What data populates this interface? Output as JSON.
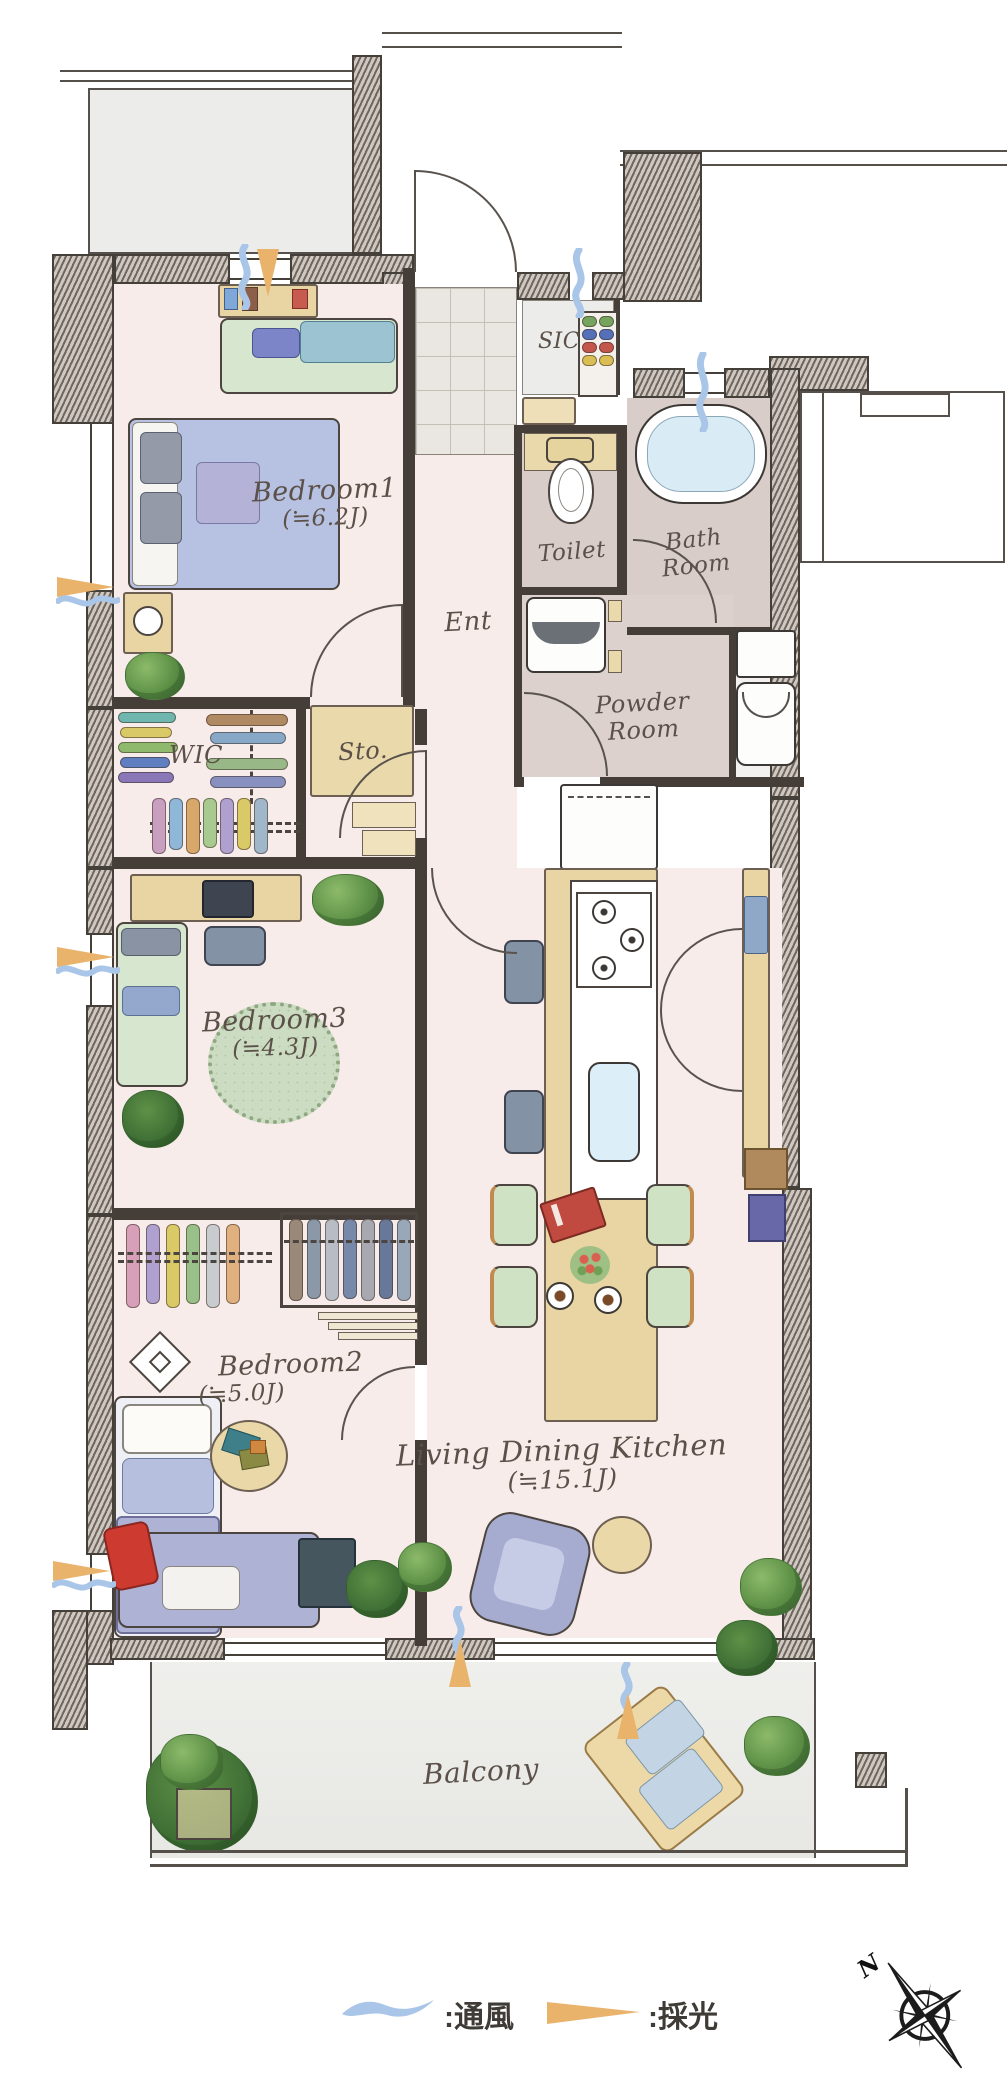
{
  "plan_title": "3LDK apartment floor plan",
  "rooms": {
    "bedroom1": {
      "name": "Bedroom1",
      "area": "(≒6.2J)"
    },
    "bedroom2": {
      "name": "Bedroom2",
      "area": "(≒5.0J)"
    },
    "bedroom3": {
      "name": "Bedroom3",
      "area": "(≒4.3J)"
    },
    "ldk": {
      "name": "Living Dining Kitchen",
      "area": "(≒15.1J)"
    },
    "ent": {
      "name": "Ent"
    },
    "sic": {
      "name": "SIC"
    },
    "toilet": {
      "name": "Toilet"
    },
    "bath": {
      "name": "Bath Room"
    },
    "powder": {
      "name": "Powder Room"
    },
    "wic": {
      "name": "WIC"
    },
    "sto": {
      "name": "Sto."
    },
    "balcony": {
      "name": "Balcony"
    }
  },
  "legend": {
    "ventilation_label": ":通風",
    "daylight_label": ":採光"
  },
  "compass": {
    "north_label": "N"
  },
  "colors": {
    "floor_pink": "#f8ecea",
    "wet_area_floor": "#d9cdc9",
    "wood_tan": "#e9d5a4",
    "furniture_blue": "#b5bedf",
    "furniture_green": "#cfe3c4",
    "ventilation_blue": "#a9c6e8",
    "daylight_orange": "#e9b36c",
    "wall_dark": "#453f3a"
  }
}
